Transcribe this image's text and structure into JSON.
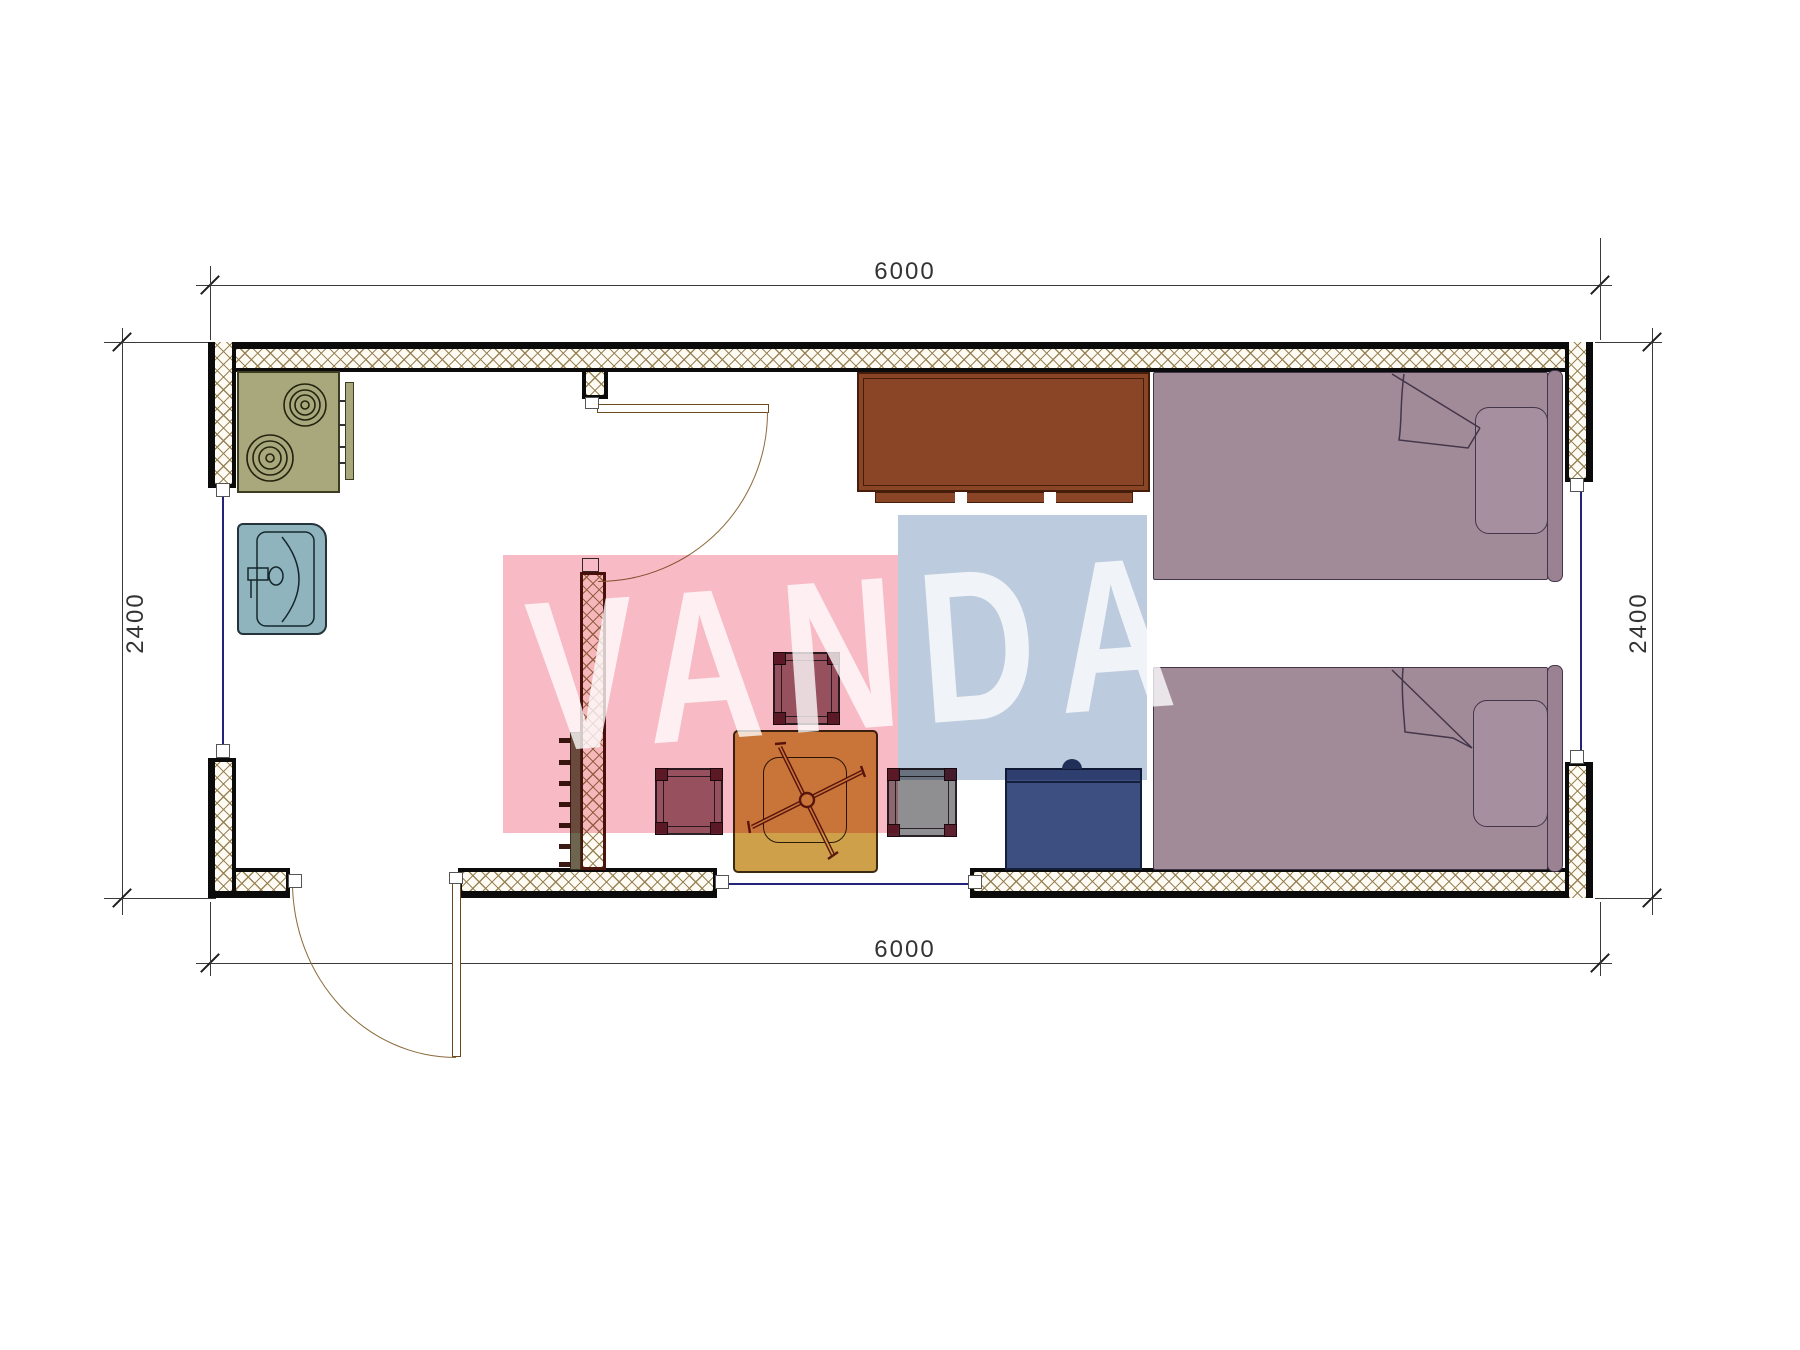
{
  "drawing": {
    "type": "architectural-floor-plan",
    "unit_note": "dimension labels as shown on screen",
    "dimensions": {
      "top": "6000",
      "bottom": "6000",
      "left": "2400",
      "right": "2400"
    },
    "watermark": {
      "text": "VANDA",
      "pink_color": "#f8bac4",
      "blue_color": "#bccbde",
      "text_color": "#ffffff"
    },
    "walls": {
      "outer_color": "#0b0b0b",
      "hatch_line_color": "#947e50",
      "partition_border_color": "#4a150c"
    },
    "furniture": [
      {
        "name": "stove-cooktop",
        "burners": 2,
        "color": "#a8a87c"
      },
      {
        "name": "kitchen-sink",
        "color": "#8fb4bd"
      },
      {
        "name": "cabinet",
        "color": "#8a4526"
      },
      {
        "name": "bed-top",
        "color": "#a28b98"
      },
      {
        "name": "bed-bottom",
        "color": "#a28b98"
      },
      {
        "name": "folding-table",
        "color": "#cfa04a"
      },
      {
        "name": "stool-north",
        "color": "#9b6f7a"
      },
      {
        "name": "stool-west",
        "color": "#9b6f7a"
      },
      {
        "name": "stool-east",
        "color": "#8f8f92"
      },
      {
        "name": "washing-machine",
        "color": "#3d4e80"
      },
      {
        "name": "wall-shelf-with-hooks",
        "color": "#6e6550"
      }
    ],
    "openings": [
      {
        "name": "entrance-door",
        "location": "bottom-left"
      },
      {
        "name": "interior-door",
        "location": "top-center"
      },
      {
        "name": "window-left"
      },
      {
        "name": "window-right"
      },
      {
        "name": "window-bottom"
      }
    ]
  }
}
